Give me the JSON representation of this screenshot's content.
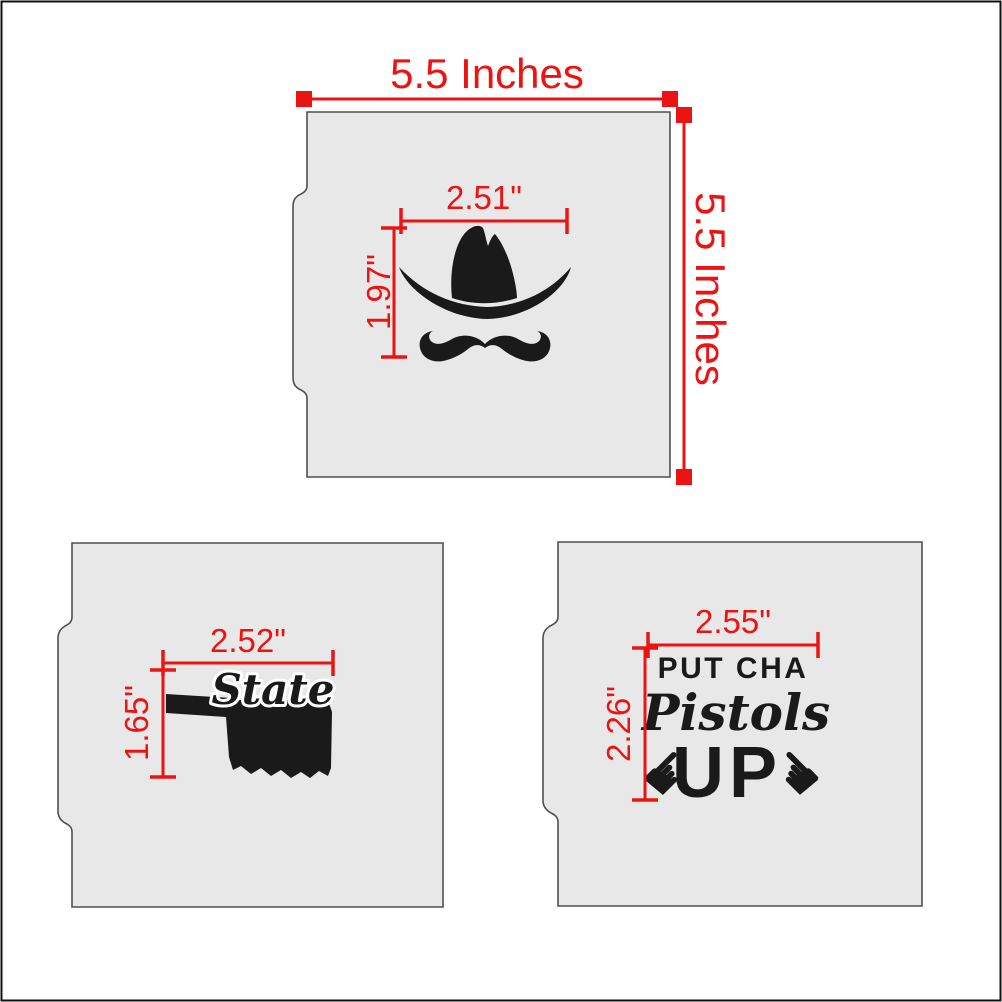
{
  "colors": {
    "dimension_red": "#ec1313",
    "design_black": "#1a1a1a",
    "stencil_fill": "#e8e8e8",
    "stencil_outline": "#4f4f4f"
  },
  "icons": {
    "hand_left": "☛",
    "hand_right": "☚"
  },
  "top_stencil": {
    "outer_width_label": "5.5 Inches",
    "outer_height_label": "5.5 Inches",
    "design_width_label": "2.51\"",
    "design_height_label": "1.97\""
  },
  "state_stencil": {
    "design_width_label": "2.52\"",
    "design_height_label": "1.65\"",
    "word": "State"
  },
  "pistols_stencil": {
    "design_width_label": "2.55\"",
    "design_height_label": "2.26\"",
    "line1": "PUT CHA",
    "line2": "Pistols",
    "line3": "UP"
  }
}
